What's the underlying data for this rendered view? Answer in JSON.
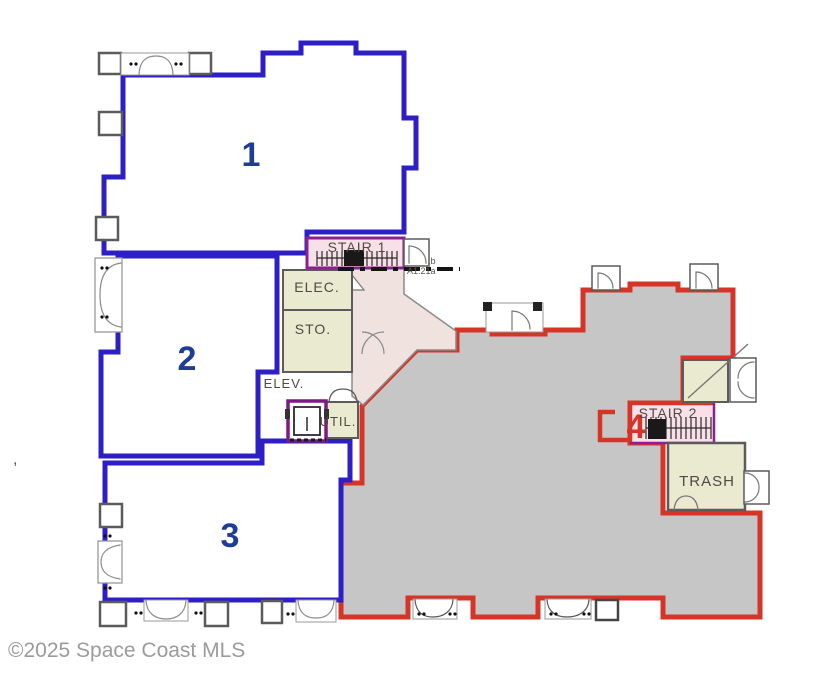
{
  "image": {
    "type": "floor-plan"
  },
  "watermark": "©2025 Space Coast MLS",
  "units": {
    "unit1": {
      "number": "1"
    },
    "unit2": {
      "number": "2"
    },
    "unit3": {
      "number": "3"
    },
    "unit4": {
      "number": "4"
    }
  },
  "rooms": {
    "stair1": {
      "label": "STAIR 1"
    },
    "elec": {
      "label": "ELEC."
    },
    "sto": {
      "label": "STO."
    },
    "elev": {
      "label": "ELEV."
    },
    "util": {
      "label": "UTIL."
    },
    "stair2": {
      "label": "STAIR 2"
    },
    "trash": {
      "label": "TRASH"
    }
  },
  "annotations": {
    "section_marker_top": "A1.21b",
    "section_marker_bottom": "A1.21a",
    "stray_mark": ","
  },
  "colors": {
    "unit_boundary_blue": "#2d1fc5",
    "unit_boundary_red": "#d63427",
    "unit4_fill": "#c6c6c6",
    "service_room_fill": "#eaead0",
    "corridor_fill": "#f0e2de",
    "stair_room_fill": "#f8e0e8",
    "stair_outline_purple": "#8c2090",
    "wall_gray": "#5b5b5b",
    "unit_number_blue": "#1e3d96",
    "watermark_gray": "#9b9b9b"
  }
}
